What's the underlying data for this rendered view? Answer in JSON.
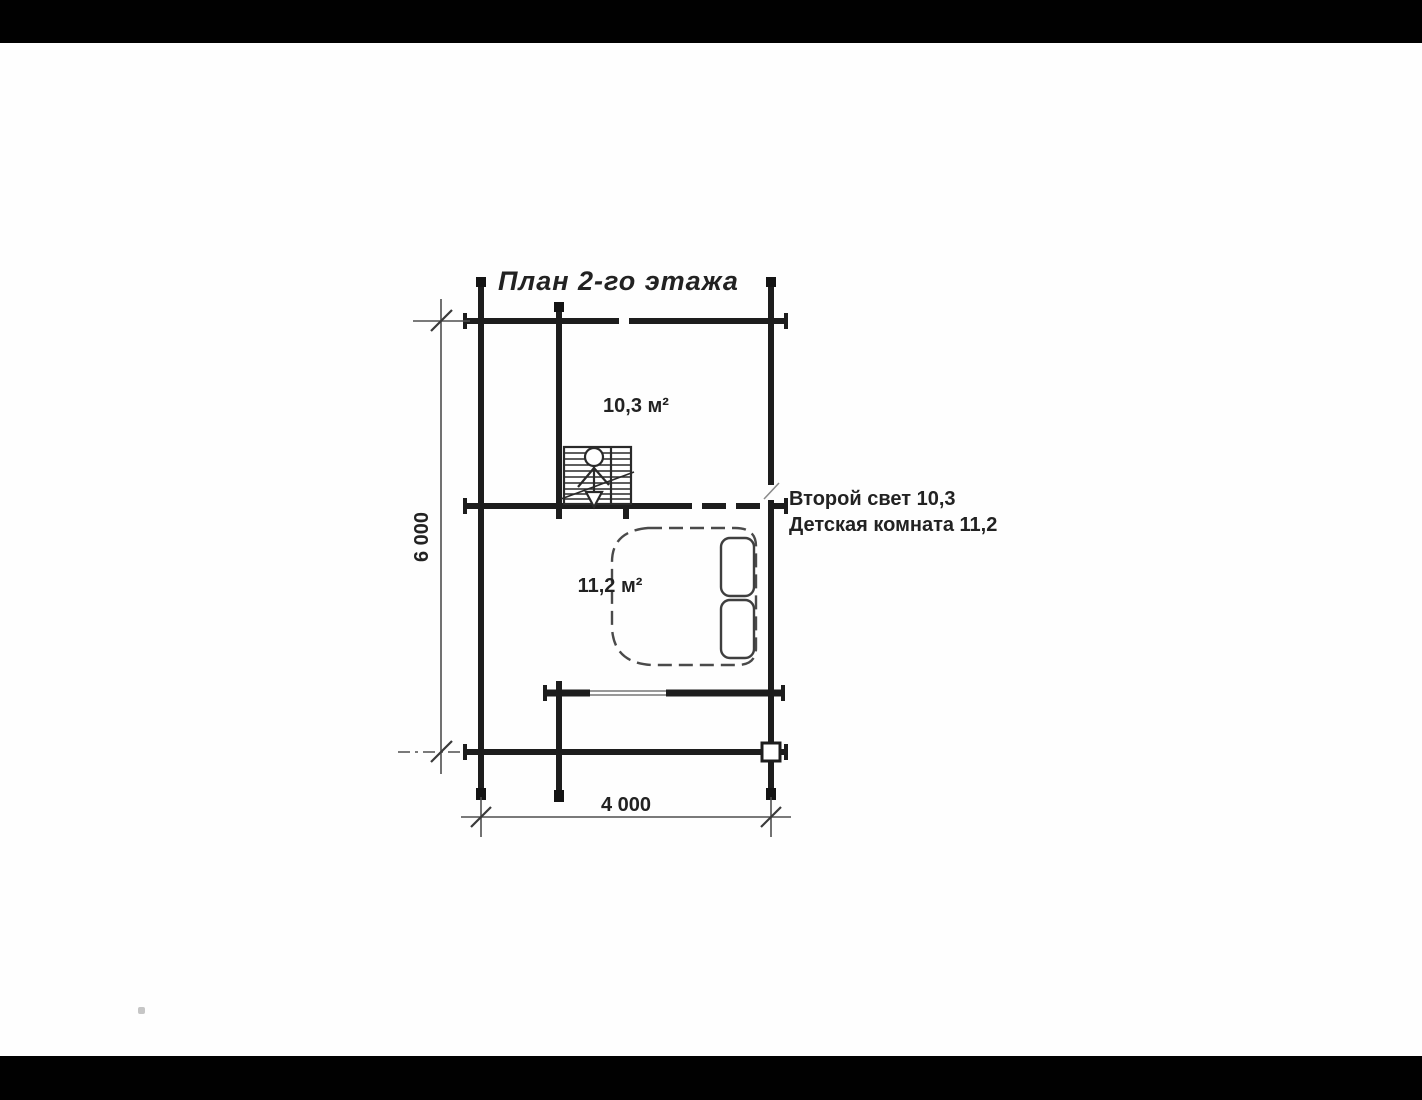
{
  "page": {
    "background_color": "#ffffff",
    "letterbox_color": "#010101"
  },
  "plan": {
    "title": "План 2-го этажа",
    "room_labels": {
      "upper": "10,3 м²",
      "lower": "11,2 м²"
    },
    "annotations": {
      "line1": "Второй свет 10,3",
      "line2": "Детская комната 11,2"
    },
    "dimensions": {
      "height": "6 000",
      "width": "4 000"
    },
    "colors": {
      "wall": "#1d1d1d",
      "dimension_line": "#4e4e4e",
      "furniture_line": "#4a4a4a",
      "text": "#222222"
    }
  }
}
